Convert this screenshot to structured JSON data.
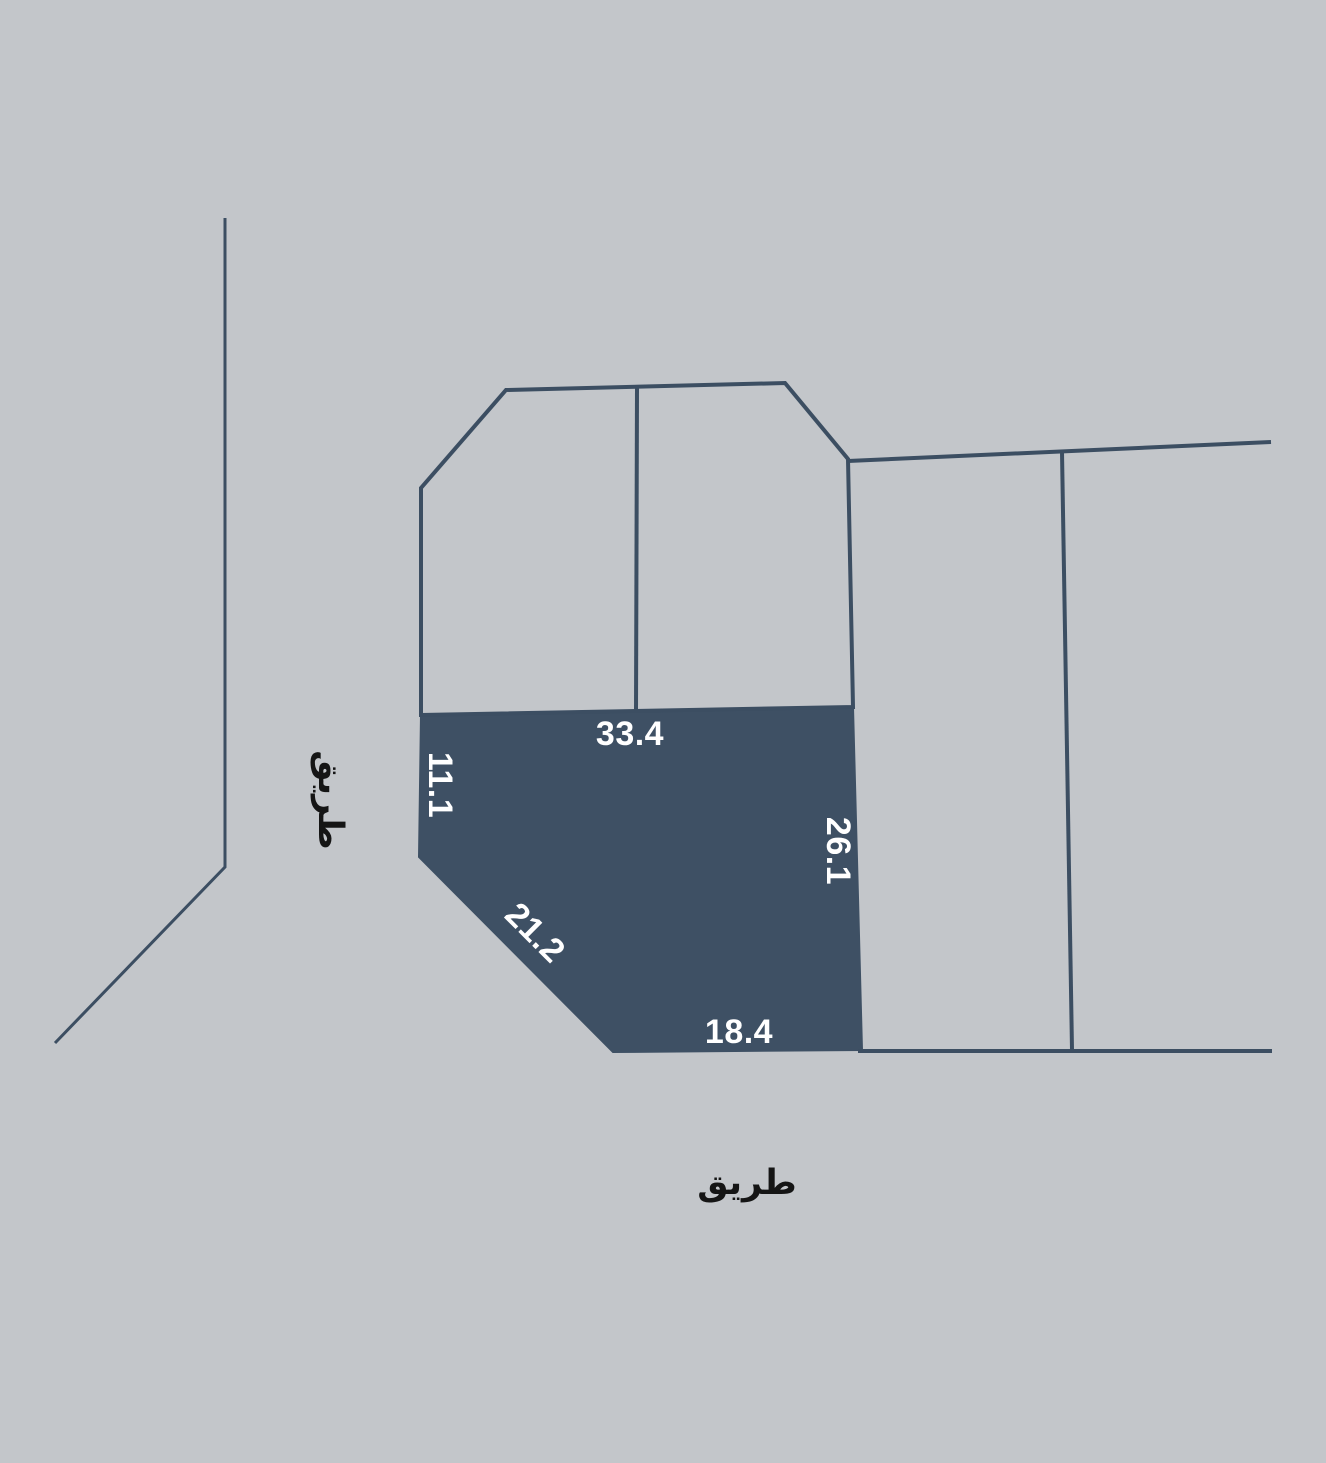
{
  "map": {
    "background_color": "#c3c6ca",
    "line_color": "#3c4e62",
    "plot_fill_color": "#3e5064",
    "dimension_text_color": "#ffffff",
    "road_text_color": "#151515",
    "shapes": [
      {
        "name": "selected-plot-polygon",
        "type": "polygon",
        "interactable": true,
        "filled": true,
        "stroke_width": 2,
        "geometry": {
          "points": "421,715 853,707 862,1050 613,1052 419,857"
        }
      },
      {
        "name": "road-boundary-left",
        "type": "polyline",
        "interactable": false,
        "filled": false,
        "stroke_width": 3,
        "geometry": {
          "points": "225,218 225,867 55,1043"
        }
      },
      {
        "name": "upper-block-outline",
        "type": "polygon",
        "interactable": false,
        "filled": false,
        "stroke_width": 4,
        "geometry": {
          "points": "506,390 785,383 848,459 853,707 421,715 421,488"
        }
      },
      {
        "name": "upper-block-divider",
        "type": "line",
        "interactable": false,
        "filled": false,
        "stroke_width": 4,
        "geometry": {
          "x1": "637",
          "y1": "388",
          "x2": "636",
          "y2": "712"
        }
      },
      {
        "name": "right-block-top-boundary",
        "type": "line",
        "interactable": false,
        "filled": false,
        "stroke_width": 4,
        "geometry": {
          "x1": "848",
          "y1": "461",
          "x2": "1271",
          "y2": "442"
        }
      },
      {
        "name": "right-block-divider",
        "type": "line",
        "interactable": false,
        "filled": false,
        "stroke_width": 4,
        "geometry": {
          "x1": "1062",
          "y1": "452",
          "x2": "1072",
          "y2": "1050"
        }
      },
      {
        "name": "road-boundary-bottom",
        "type": "line",
        "interactable": false,
        "filled": false,
        "stroke_width": 4,
        "geometry": {
          "x1": "858",
          "y1": "1051",
          "x2": "1272",
          "y2": "1051"
        }
      }
    ],
    "dimension_labels": [
      {
        "name": "dimension-top",
        "text": "33.4",
        "x": 630,
        "y": 734,
        "rotation": 0
      },
      {
        "name": "dimension-left",
        "text": "11.1",
        "x": 440,
        "y": 785,
        "rotation": 90
      },
      {
        "name": "dimension-right",
        "text": "26.1",
        "x": 838,
        "y": 851,
        "rotation": 90
      },
      {
        "name": "dimension-diagonal",
        "text": "21.2",
        "x": 535,
        "y": 933,
        "rotation": 45
      },
      {
        "name": "dimension-bottom",
        "text": "18.4",
        "x": 739,
        "y": 1032,
        "rotation": 0
      }
    ],
    "road_labels": [
      {
        "name": "road-label-left",
        "text": "طريق",
        "x": 330,
        "y": 800,
        "rotation": 90
      },
      {
        "name": "road-label-bottom",
        "text": "طريق",
        "x": 747,
        "y": 1183,
        "rotation": 0
      }
    ]
  }
}
